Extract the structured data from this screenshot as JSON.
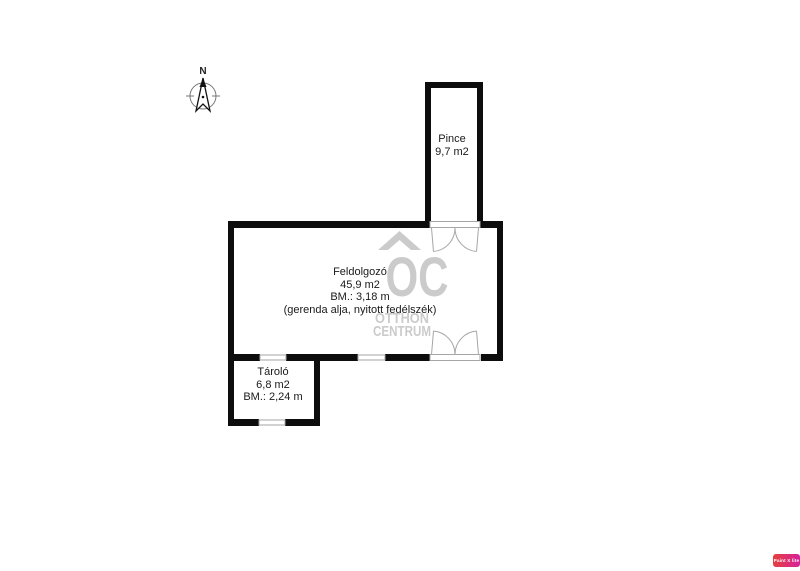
{
  "compass": {
    "north_label": "N"
  },
  "rooms": {
    "pince": {
      "name": "Pince",
      "area": "9,7 m2"
    },
    "feldolgozo": {
      "name": "Feldolgozó",
      "area": "45,9 m2",
      "ceiling": "BM.: 3,18 m",
      "note": "(gerenda alja, nyitott fedélszék)"
    },
    "tarolo": {
      "name": "Tároló",
      "area": "6,8 m2",
      "ceiling": "BM.: 2,24 m"
    }
  },
  "watermark": {
    "logo": "OC",
    "line1": "OTTHON",
    "line2": "CENTRUM",
    "color": "#cbcbcb"
  },
  "badge": {
    "label": "Paint X lite",
    "color_left": "#e5403c",
    "color_right": "#d6219c"
  },
  "colors": {
    "wall": "#0d0d0d",
    "opening_stroke": "#a6a6a6",
    "text": "#1a1a1a"
  }
}
